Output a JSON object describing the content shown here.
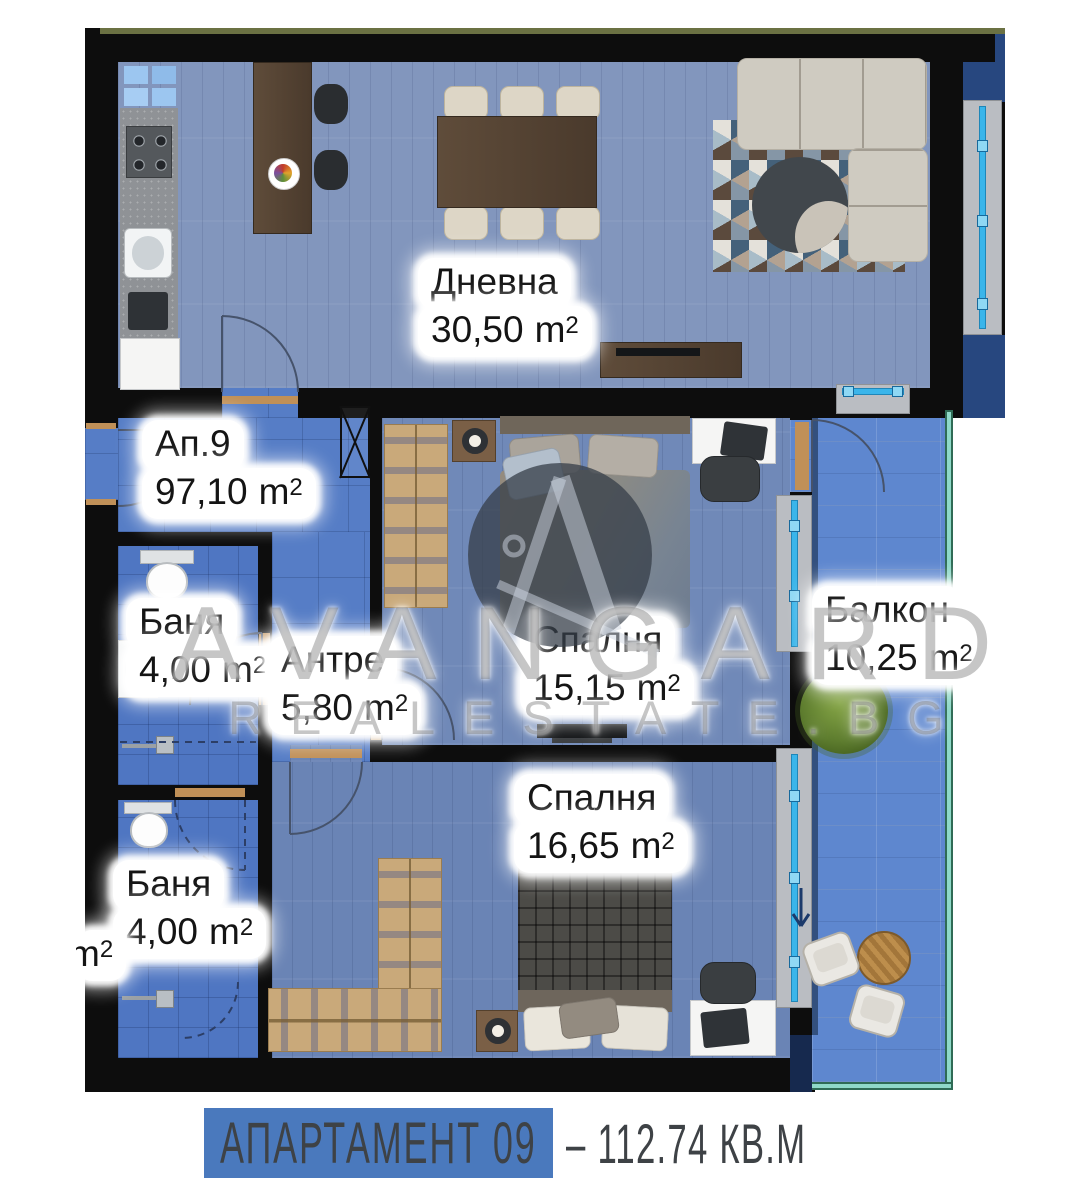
{
  "rooms": [
    {
      "id": "living",
      "name": "Дневна",
      "area": "30,50",
      "unit": "m",
      "exp": "2"
    },
    {
      "id": "apartment",
      "name": "Ап.9",
      "area": "97,10",
      "unit": "m",
      "exp": "2"
    },
    {
      "id": "bath1",
      "name": "Баня",
      "area": "4,00",
      "unit": "m",
      "exp": "2"
    },
    {
      "id": "hallway",
      "name": "Антре",
      "area": "5,80",
      "unit": "m",
      "exp": "2"
    },
    {
      "id": "bedroom1",
      "name": "Спалня",
      "area": "15,15",
      "unit": "m",
      "exp": "2"
    },
    {
      "id": "balcony",
      "name": "Балкон",
      "area": "10,25",
      "unit": "m",
      "exp": "2"
    },
    {
      "id": "bath2",
      "name": "Баня",
      "area": "4,00",
      "unit": "m",
      "exp": "2"
    },
    {
      "id": "bedroom2",
      "name": "Спалня",
      "area": "16,65",
      "unit": "m",
      "exp": "2"
    },
    {
      "id": "partial-neighbor-label",
      "name": "",
      "area": "",
      "unit": "m",
      "exp": "2"
    }
  ],
  "watermark": {
    "brand": "AVANGARD",
    "site": "REALESTATE.BG",
    "logo": "avangard-a-compass-logo"
  },
  "footer": {
    "apartment_label": "АПАРТАМЕНТ 09",
    "separator": "–",
    "total_area": "112.74 КВ.М"
  },
  "colors": {
    "wall": "#0d0d0d",
    "banner_blue": "#4a79bd",
    "footer_text": "#3e4246",
    "living_floor": "#8296bd",
    "bedroom_floor": "#7089b8",
    "tile_floor": "#567dc6",
    "bath_floor": "#4f76c2",
    "balcony_floor": "#5e87cf",
    "window_line_cyan": "#3ab5ea",
    "window_sill_gray": "#babdc2",
    "railing_teal": "#8fd9c8",
    "railing_edge": "#2f6b55",
    "door_threshold_tan": "#c09058",
    "accent_dark_blue": "#27477f",
    "roof_olive": "#6b7143"
  }
}
